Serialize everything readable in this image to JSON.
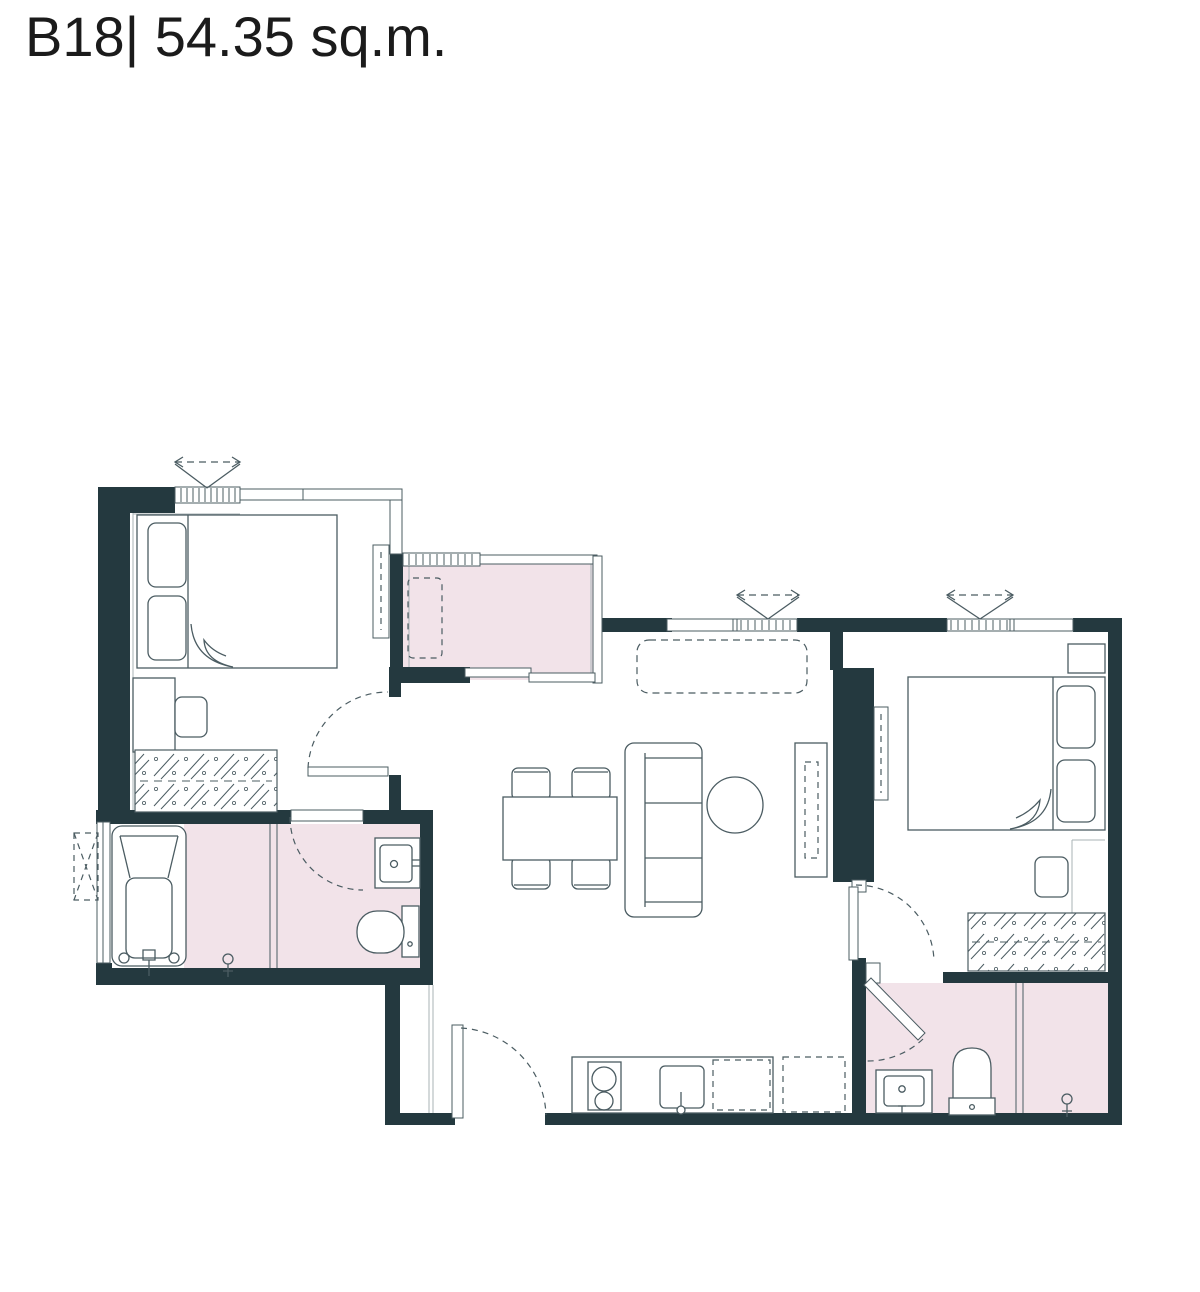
{
  "title": {
    "text": "B18| 54.35 sq.m."
  },
  "colors": {
    "background": "#ffffff",
    "wall": "#24393f",
    "line": "#4b5c62",
    "light_line": "#a8b3b6",
    "floor_accent": "#f2e3e9",
    "title_text": "#1b1b1b"
  }
}
